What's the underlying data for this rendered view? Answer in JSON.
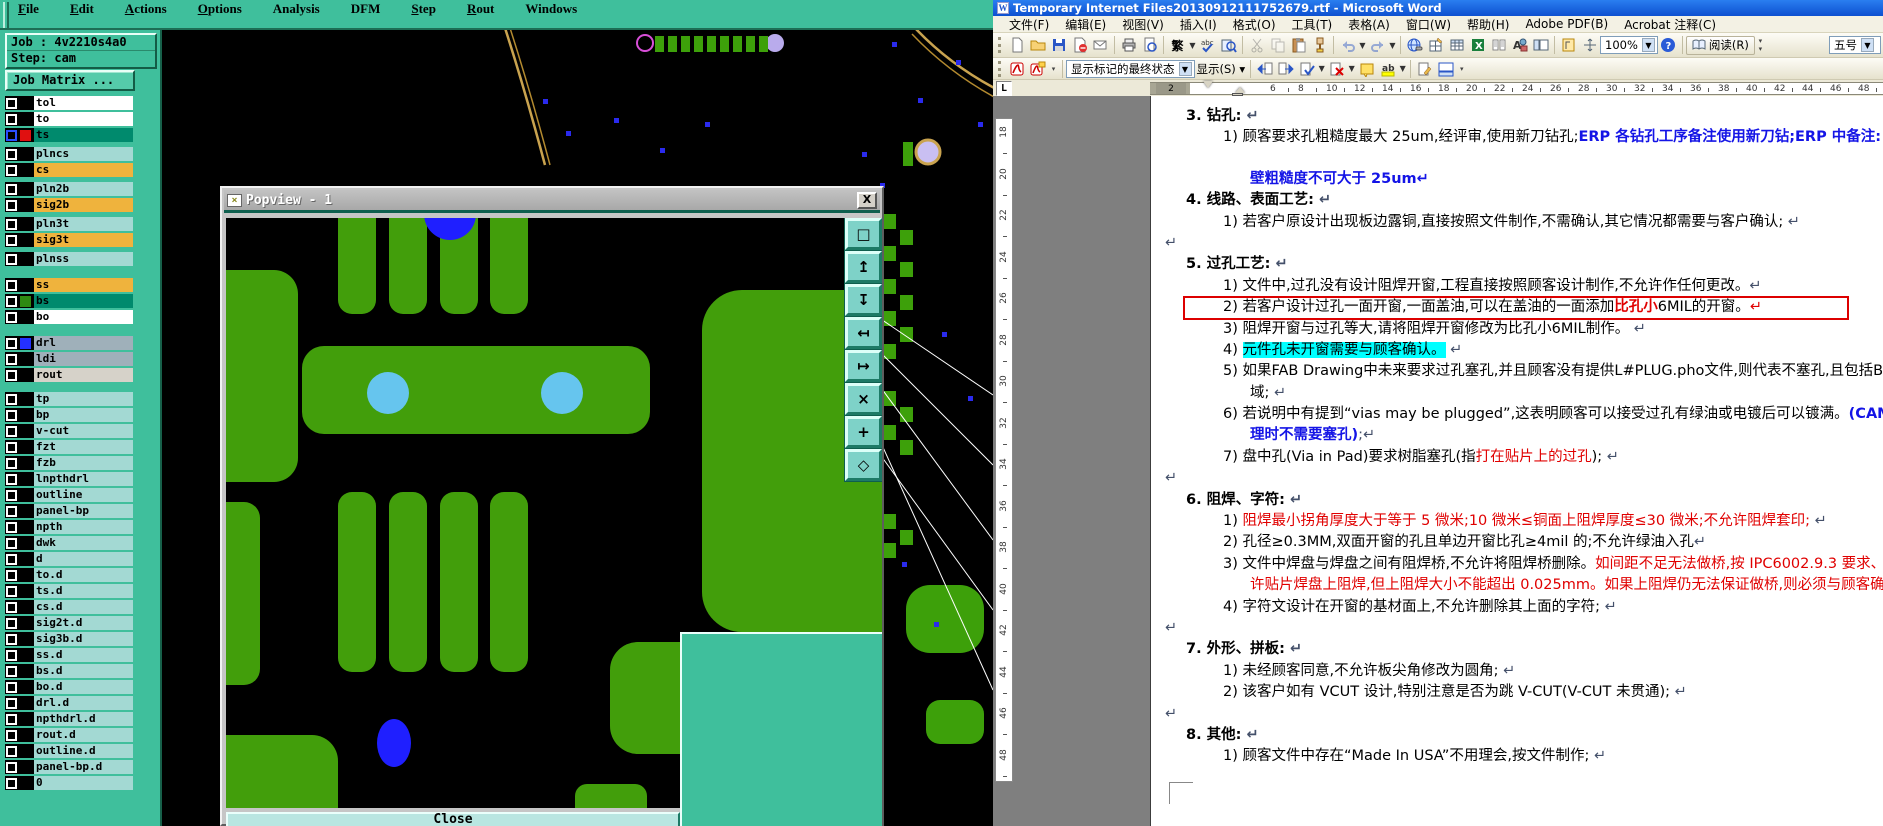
{
  "cam": {
    "menu": [
      {
        "label": "File",
        "u": true
      },
      {
        "label": "Edit",
        "u": true
      },
      {
        "label": "Actions",
        "u": true
      },
      {
        "label": "Options",
        "u": true
      },
      {
        "label": "Analysis",
        "u": false
      },
      {
        "label": "DFM",
        "u": false
      },
      {
        "label": "Step",
        "u": true
      },
      {
        "label": "Rout",
        "u": true
      },
      {
        "label": "Windows",
        "u": false
      }
    ],
    "job_label": "Job : 4v2210s4a0",
    "step_label": "Step: cam",
    "job_matrix_label": "Job Matrix ...",
    "layer_colors": {
      "white": "#ffffff",
      "orange": "#efb33d",
      "cyan": "#a3d9d3",
      "teal": "#008a6d",
      "gray": "#9fb0ba",
      "lightgray": "#d6d2c9"
    },
    "swatch_colors": {
      "red": "#e01010",
      "green": "#2e8a12",
      "blue": "#2430ff",
      "black": "#000000"
    },
    "layers": [
      {
        "name": "tol",
        "c": "white",
        "sw": "black",
        "sel": false
      },
      {
        "name": "to",
        "c": "white",
        "sw": "black",
        "sel": false
      },
      {
        "name": "ts",
        "c": "teal",
        "sw": "red",
        "sel": true
      },
      {
        "name": "plncs",
        "c": "cyan",
        "sw": "black",
        "sel": false
      },
      {
        "name": "cs",
        "c": "orange",
        "sw": "black",
        "sel": false
      },
      {
        "name": "pln2b",
        "c": "cyan",
        "sw": "black",
        "sel": false
      },
      {
        "name": "sig2b",
        "c": "orange",
        "sw": "black",
        "sel": false
      },
      {
        "name": "pln3t",
        "c": "cyan",
        "sw": "black",
        "sel": false
      },
      {
        "name": "sig3t",
        "c": "orange",
        "sw": "black",
        "sel": false
      },
      {
        "name": "plnss",
        "c": "cyan",
        "sw": "black",
        "sel": false
      },
      {
        "name": "ss",
        "c": "orange",
        "sw": "black",
        "sel": false
      },
      {
        "name": "bs",
        "c": "teal",
        "sw": "green",
        "sel": false
      },
      {
        "name": "bo",
        "c": "white",
        "sw": "black",
        "sel": false
      },
      {
        "name": "drl",
        "c": "gray",
        "sw": "blue",
        "sel": false
      },
      {
        "name": "ldi",
        "c": "gray",
        "sw": "black",
        "sel": false
      },
      {
        "name": "rout",
        "c": "lightgray",
        "sw": "black",
        "sel": false
      },
      {
        "name": "tp",
        "c": "cyan",
        "sw": "black",
        "sel": false
      },
      {
        "name": "bp",
        "c": "cyan",
        "sw": "black",
        "sel": false
      },
      {
        "name": "v-cut",
        "c": "cyan",
        "sw": "black",
        "sel": false
      },
      {
        "name": "fzt",
        "c": "cyan",
        "sw": "black",
        "sel": false
      },
      {
        "name": "fzb",
        "c": "cyan",
        "sw": "black",
        "sel": false
      },
      {
        "name": "lnpthdrl",
        "c": "cyan",
        "sw": "black",
        "sel": false
      },
      {
        "name": "outline",
        "c": "cyan",
        "sw": "black",
        "sel": false
      },
      {
        "name": "panel-bp",
        "c": "cyan",
        "sw": "black",
        "sel": false
      },
      {
        "name": "npth",
        "c": "cyan",
        "sw": "black",
        "sel": false
      },
      {
        "name": "dwk",
        "c": "cyan",
        "sw": "black",
        "sel": false
      },
      {
        "name": "d",
        "c": "cyan",
        "sw": "black",
        "sel": false
      },
      {
        "name": "to.d",
        "c": "cyan",
        "sw": "black",
        "sel": false
      },
      {
        "name": "ts.d",
        "c": "cyan",
        "sw": "black",
        "sel": false
      },
      {
        "name": "cs.d",
        "c": "cyan",
        "sw": "black",
        "sel": false
      },
      {
        "name": "sig2t.d",
        "c": "cyan",
        "sw": "black",
        "sel": false
      },
      {
        "name": "sig3b.d",
        "c": "cyan",
        "sw": "black",
        "sel": false
      },
      {
        "name": "ss.d",
        "c": "cyan",
        "sw": "black",
        "sel": false
      },
      {
        "name": "bs.d",
        "c": "cyan",
        "sw": "black",
        "sel": false
      },
      {
        "name": "bo.d",
        "c": "cyan",
        "sw": "black",
        "sel": false
      },
      {
        "name": "drl.d",
        "c": "cyan",
        "sw": "black",
        "sel": false
      },
      {
        "name": "npthdrl.d",
        "c": "cyan",
        "sw": "black",
        "sel": false
      },
      {
        "name": "rout.d",
        "c": "cyan",
        "sw": "black",
        "sel": false
      },
      {
        "name": "outline.d",
        "c": "cyan",
        "sw": "black",
        "sel": false
      },
      {
        "name": "panel-bp.d",
        "c": "cyan",
        "sw": "black",
        "sel": false
      },
      {
        "name": "0",
        "c": "cyan",
        "sw": "black",
        "sel": false
      }
    ],
    "popview": {
      "title": "Popview - 1",
      "close_label": "Close",
      "tools": [
        {
          "name": "window-popout-icon",
          "glyph": "□"
        },
        {
          "name": "flip-up-icon",
          "glyph": "↥"
        },
        {
          "name": "flip-down-icon",
          "glyph": "↧"
        },
        {
          "name": "flip-left-icon",
          "glyph": "↤"
        },
        {
          "name": "flip-right-icon",
          "glyph": "↦"
        },
        {
          "name": "zoom-fit-icon",
          "glyph": "×"
        },
        {
          "name": "pan-icon",
          "glyph": "+"
        },
        {
          "name": "center-view-icon",
          "glyph": "◇"
        }
      ]
    }
  },
  "word": {
    "title": "Temporary Internet Files20130912111752679.rtf - Microsoft Word",
    "menus": [
      "文件(F)",
      "编辑(E)",
      "视图(V)",
      "插入(I)",
      "格式(O)",
      "工具(T)",
      "表格(A)",
      "窗口(W)",
      "帮助(H)",
      "Adobe PDF(B)",
      "Acrobat 注释(C)"
    ],
    "toolbar": {
      "convert_label": "繁",
      "zoom_value": "100%",
      "read_label": "阅读(R)",
      "font_size_value": "五号"
    },
    "review_bar": {
      "markup_state": "显示标记的最终状态",
      "show_label": "显示(S)"
    },
    "h_ruler": {
      "margin_number": "2",
      "numbers": [
        6,
        8,
        10,
        12,
        14,
        16,
        18,
        20,
        22,
        24,
        26,
        28,
        30,
        32,
        34,
        36,
        38,
        40,
        42,
        44,
        46,
        48
      ]
    },
    "v_ruler": {
      "numbers": [
        18,
        20,
        22,
        24,
        26,
        28,
        30,
        32,
        34,
        36,
        38,
        40,
        42,
        44,
        46,
        48
      ]
    },
    "document": {
      "lines": [
        {
          "cls": "h",
          "runs": [
            {
              "t": "3.  钻孔:",
              "s": "b"
            },
            {
              "t": " ↵",
              "s": "m"
            }
          ]
        },
        {
          "cls": "i",
          "runs": [
            {
              "t": "1) 顾客要求孔粗糙度最大 25um,经评审,使用新刀钻孔;",
              "s": ""
            },
            {
              "t": "ERP 各钻孔工序备注使用新刀钻;ERP 中备注: 孔",
              "s": "bb"
            }
          ]
        },
        {
          "cls": "w",
          "sp": true,
          "runs": [
            {
              "t": "壁粗糙度不可大于 25um",
              "s": "bb"
            },
            {
              "t": "↵",
              "s": "bb"
            }
          ]
        },
        {
          "cls": "h",
          "runs": [
            {
              "t": "4.  线路、表面工艺:",
              "s": "b"
            },
            {
              "t": " ↵",
              "s": "m"
            }
          ]
        },
        {
          "cls": "i",
          "runs": [
            {
              "t": "1) 若客户原设计出现板边露铜,直接按照文件制作,不需确认,其它情况都需要与客户确认;",
              "s": ""
            },
            {
              "t": " ↵",
              "s": "m"
            }
          ]
        },
        {
          "cls": "e",
          "runs": [
            {
              "t": "↵",
              "s": "m"
            }
          ]
        },
        {
          "cls": "h",
          "runs": [
            {
              "t": "5.  过孔工艺:",
              "s": "b"
            },
            {
              "t": " ↵",
              "s": "m"
            }
          ]
        },
        {
          "cls": "i",
          "runs": [
            {
              "t": "1) 文件中,过孔没有设计阻焊开窗,工程直接按照顾客设计制作,不允许作任何更改。",
              "s": ""
            },
            {
              "t": "↵",
              "s": "m"
            }
          ]
        },
        {
          "cls": "i",
          "box": true,
          "runs": [
            {
              "t": "2) 若客户设计过孔一面开窗,一面盖油,可以在盖油的一面添加",
              "s": ""
            },
            {
              "t": "比孔小",
              "s": "rb"
            },
            {
              "t": "6MIL的开窗。",
              "s": ""
            },
            {
              "t": "↵",
              "s": "r"
            }
          ]
        },
        {
          "cls": "i",
          "runs": [
            {
              "t": "3) 阻焊开窗与过孔等大,请将阻焊开窗修改为比孔小6MIL制作。",
              "s": ""
            },
            {
              "t": " ↵",
              "s": "m"
            }
          ]
        },
        {
          "cls": "i",
          "runs": [
            {
              "t": "4) ",
              "s": ""
            },
            {
              "t": "元件孔未开窗需要与顾客确认。",
              "s": "hl"
            },
            {
              "t": " ↵",
              "s": "m"
            }
          ]
        },
        {
          "cls": "i",
          "runs": [
            {
              "t": "5) 如果FAB Drawing中未来要求过孔塞孔,并且顾客没有提供L#PLUG.pho文件,则代表不塞孔,且包括BGA区",
              "s": ""
            }
          ]
        },
        {
          "cls": "w",
          "runs": [
            {
              "t": "域;",
              "s": ""
            },
            {
              "t": " ↵",
              "s": "m"
            }
          ]
        },
        {
          "cls": "i",
          "runs": [
            {
              "t": "6) 若说明中有提到“vias may be plugged”,这表明顾客可以接受过孔有绿油或电镀后可以镀满。",
              "s": ""
            },
            {
              "t": "(CAM处",
              "s": "bb"
            }
          ]
        },
        {
          "cls": "w",
          "runs": [
            {
              "t": "理时不需要塞孔)",
              "s": "bb"
            },
            {
              "t": ";↵",
              "s": "m"
            }
          ]
        },
        {
          "cls": "i",
          "runs": [
            {
              "t": "7) 盘中孔(Via in Pad)要求树脂塞孔(指",
              "s": ""
            },
            {
              "t": "打在贴片上的过孔",
              "s": "r"
            },
            {
              "t": ");",
              "s": ""
            },
            {
              "t": " ↵",
              "s": "m"
            }
          ]
        },
        {
          "cls": "e",
          "runs": [
            {
              "t": "↵",
              "s": "m"
            }
          ]
        },
        {
          "cls": "h",
          "runs": [
            {
              "t": "6.  阻焊、字符:",
              "s": "b"
            },
            {
              "t": " ↵",
              "s": "m"
            }
          ]
        },
        {
          "cls": "i",
          "runs": [
            {
              "t": "1) ",
              "s": ""
            },
            {
              "t": "阻焊最小拐角厚度大于等于 5 微米;10 微米≤铜面上阻焊厚度≤30 微米;不允许阻焊套印;",
              "s": "r"
            },
            {
              "t": " ↵",
              "s": "m"
            }
          ]
        },
        {
          "cls": "i",
          "runs": [
            {
              "t": "2) 孔径≥0.3MM,双面开窗的孔且单边开窗比孔≥4mil 的;不允许绿油入孔",
              "s": ""
            },
            {
              "t": "↵",
              "s": "m"
            }
          ]
        },
        {
          "cls": "i",
          "runs": [
            {
              "t": "3) 文件中焊盘与焊盘之间有阻焊桥,不允许将阻焊桥删除。",
              "s": ""
            },
            {
              "t": "如间距不足无法做桥,按 IPC6002.9.3 要求、允",
              "s": "r"
            }
          ]
        },
        {
          "cls": "w",
          "runs": [
            {
              "t": "许贴片焊盘上阻焊,但上阻焊大小不能超出 0.025mm。如果上阻焊仍无法保证做桥,则必须与顾客确认;",
              "s": "r"
            }
          ]
        },
        {
          "cls": "i",
          "runs": [
            {
              "t": "4) 字符文设计在开窗的基材面上,不允许删除其上面的字符;",
              "s": ""
            },
            {
              "t": " ↵",
              "s": "m"
            }
          ]
        },
        {
          "cls": "e",
          "runs": [
            {
              "t": "↵",
              "s": "m"
            }
          ]
        },
        {
          "cls": "h",
          "runs": [
            {
              "t": "7.  外形、拼板:",
              "s": "b"
            },
            {
              "t": " ↵",
              "s": "m"
            }
          ]
        },
        {
          "cls": "i",
          "runs": [
            {
              "t": "1) 未经顾客同意,不允许板尖角修改为圆角;",
              "s": ""
            },
            {
              "t": " ↵",
              "s": "m"
            }
          ]
        },
        {
          "cls": "i",
          "runs": [
            {
              "t": "2) 该客户如有 VCUT 设计,特别注意是否为跳 V-CUT(V-CUT 未贯通);",
              "s": ""
            },
            {
              "t": " ↵",
              "s": "m"
            }
          ]
        },
        {
          "cls": "e",
          "runs": [
            {
              "t": "↵",
              "s": "m"
            }
          ]
        },
        {
          "cls": "h",
          "runs": [
            {
              "t": "8.  其他:",
              "s": "b"
            },
            {
              "t": " ↵",
              "s": "m"
            }
          ]
        },
        {
          "cls": "i",
          "runs": [
            {
              "t": "1) 顾客文件中存在“Made In USA”不用理会,按文件制作;",
              "s": ""
            },
            {
              "t": " ↵",
              "s": "m"
            }
          ]
        }
      ]
    }
  }
}
